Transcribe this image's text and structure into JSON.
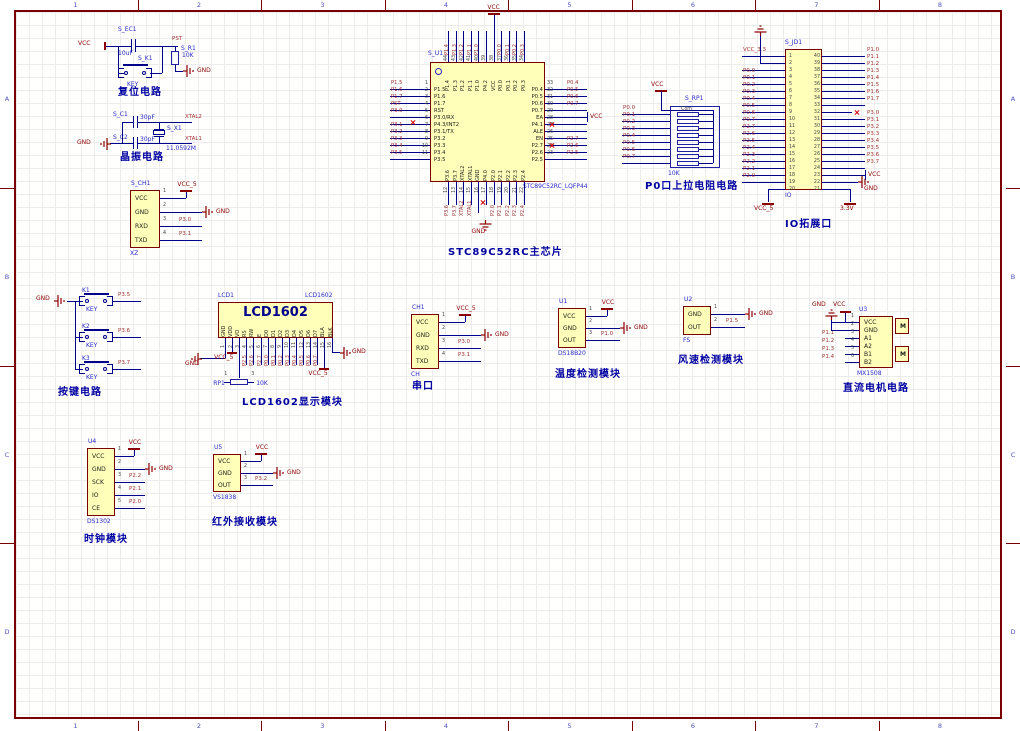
{
  "sheet": {
    "zone_cols": [
      "1",
      "2",
      "3",
      "4",
      "5",
      "6",
      "7",
      "8"
    ],
    "zone_rows": [
      "A",
      "B",
      "C",
      "D"
    ]
  },
  "captions": {
    "reset": "复位电路",
    "crystal": "晶振电路",
    "mcu": "STC89C52RC主芯片",
    "pullup": "P0口上拉电阻电路",
    "io": "IO拓展口",
    "keys": "按键电路",
    "lcd": "LCD1602显示模块",
    "serial": "串口",
    "temp": "温度检测模块",
    "wind": "风速检测模块",
    "motor": "直流电机电路",
    "clock": "时钟模块",
    "ir": "红外接收模块"
  },
  "reset": {
    "vcc": "VCC",
    "cap_ref": "S_EC1",
    "cap_val": "10uF",
    "key_ref": "S_K1",
    "key_label": "KEY",
    "pst": "PST",
    "res_ref": "S_R1",
    "res_val": "10K",
    "gnd": "GND"
  },
  "crystal": {
    "c1_ref": "S_C1",
    "c1_val": "30pF",
    "net_top": "XTAL2",
    "c2_ref": "S_C2",
    "c2_val": "30pF",
    "net_bottom": "XTAL1",
    "x_ref": "S_X1",
    "x_val": "11.0592M",
    "gnd": "GND"
  },
  "xz": {
    "ref": "S_CH1",
    "part": "XZ",
    "pins": [
      {
        "num": "1",
        "name": "VCC",
        "net": "VCC_5",
        "sym": "vcc"
      },
      {
        "num": "2",
        "name": "GND",
        "net": "GND",
        "sym": "gnd"
      },
      {
        "num": "3",
        "name": "RXD",
        "net": "P3.0",
        "sym": "label"
      },
      {
        "num": "4",
        "name": "TXD",
        "net": "P3.1",
        "sym": "label"
      }
    ]
  },
  "serial": {
    "ref": "CH1",
    "part": "CH",
    "pins": [
      {
        "num": "1",
        "name": "VCC",
        "net": "VCC_5",
        "sym": "vcc"
      },
      {
        "num": "2",
        "name": "GND",
        "net": "GND",
        "sym": "gnd"
      },
      {
        "num": "3",
        "name": "RXD",
        "net": "P3.0",
        "sym": "label"
      },
      {
        "num": "4",
        "name": "TXD",
        "net": "P3.1",
        "sym": "label"
      }
    ]
  },
  "temp": {
    "ref": "U1",
    "part": "DS18B20",
    "pins": [
      {
        "num": "1",
        "name": "VCC",
        "net": "VCC",
        "sym": "vcc"
      },
      {
        "num": "2",
        "name": "GND",
        "net": "GND",
        "sym": "gnd"
      },
      {
        "num": "3",
        "name": "OUT",
        "net": "P1.0",
        "sym": "label"
      }
    ]
  },
  "wind": {
    "ref": "U2",
    "part": "FS",
    "pins": [
      {
        "num": "1",
        "name": "GND",
        "net": "GND",
        "sym": "gnd"
      },
      {
        "num": "2",
        "name": "OUT",
        "net": "P1.5",
        "sym": "label"
      }
    ]
  },
  "clock": {
    "ref": "U4",
    "part": "DS1302",
    "pins": [
      {
        "num": "1",
        "name": "VCC",
        "net": "VCC",
        "sym": "vcc"
      },
      {
        "num": "2",
        "name": "GND",
        "net": "GND",
        "sym": "gnd"
      },
      {
        "num": "3",
        "name": "SCK",
        "net": "P2.2",
        "sym": "label"
      },
      {
        "num": "4",
        "name": "IO",
        "net": "P2.1",
        "sym": "label"
      },
      {
        "num": "5",
        "name": "CE",
        "net": "P2.0",
        "sym": "label"
      }
    ]
  },
  "ir": {
    "ref": "U5",
    "part": "VS1838",
    "pins": [
      {
        "num": "1",
        "name": "VCC",
        "net": "VCC",
        "sym": "vcc"
      },
      {
        "num": "2",
        "name": "GND",
        "net": "GND",
        "sym": "gnd"
      },
      {
        "num": "3",
        "name": "OUT",
        "net": "P3.2",
        "sym": "label"
      }
    ]
  },
  "motor": {
    "ref": "U3",
    "part": "MX1508",
    "gnd": "GND",
    "vcc": "VCC",
    "m_label": "M",
    "pins": [
      {
        "num": "1",
        "name": "VCC"
      },
      {
        "num": "2",
        "name": "GND"
      },
      {
        "num": "3",
        "name": "A1",
        "net": "P1.1"
      },
      {
        "num": "4",
        "name": "A2",
        "net": "P1.2"
      },
      {
        "num": "5",
        "name": "B1",
        "net": "P1.3"
      },
      {
        "num": "6",
        "name": "B2",
        "net": "P1.4"
      }
    ]
  },
  "keys": {
    "gnd": "GND",
    "items": [
      {
        "ref": "K1",
        "label": "KEY",
        "net": "P3.5"
      },
      {
        "ref": "K2",
        "label": "KEY",
        "net": "P3.6"
      },
      {
        "ref": "K3",
        "label": "KEY",
        "net": "P3.7"
      }
    ]
  },
  "pullup": {
    "ref": "S_RP1",
    "com": "Com",
    "value": "10K",
    "vcc": "VCC",
    "nets": [
      "P0.0",
      "P0.1",
      "P0.2",
      "P0.3",
      "P0.4",
      "P0.5",
      "P0.6",
      "P0.7"
    ]
  },
  "lcd": {
    "ref": "LCD1",
    "part": "LCD1602",
    "title": "LCD1602",
    "pot_ref": "RP1",
    "pot_val": "10K",
    "pot_p1": "1",
    "pot_p3": "3",
    "vcc_left": "VCC_5",
    "vcc_right": "VCC_5",
    "gnd_left": "GND",
    "gnd_right": "GND",
    "pins": [
      {
        "num": "1",
        "name": "GND",
        "sym": "gnd-left"
      },
      {
        "num": "2",
        "name": "VDD",
        "sym": "vccl"
      },
      {
        "num": "3",
        "name": "VO",
        "sym": "pot"
      },
      {
        "num": "4",
        "name": "RS",
        "net": "P2.5"
      },
      {
        "num": "5",
        "name": "RW",
        "net": "P2.6"
      },
      {
        "num": "6",
        "name": "E",
        "net": "P2.7"
      },
      {
        "num": "7",
        "name": "D0",
        "net": "P0.0"
      },
      {
        "num": "8",
        "name": "D1",
        "net": "P0.1"
      },
      {
        "num": "9",
        "name": "D2",
        "net": "P0.2"
      },
      {
        "num": "10",
        "name": "D3",
        "net": "P0.3"
      },
      {
        "num": "11",
        "name": "D4",
        "net": "P0.4"
      },
      {
        "num": "12",
        "name": "D5",
        "net": "P0.5"
      },
      {
        "num": "13",
        "name": "D6",
        "net": "P0.6"
      },
      {
        "num": "14",
        "name": "D7",
        "net": "P0.7"
      },
      {
        "num": "15",
        "name": "BLA",
        "sym": "vccr"
      },
      {
        "num": "16",
        "name": "BLK",
        "sym": "gnd-right"
      }
    ]
  },
  "mcu": {
    "ref": "S_U1",
    "part": "STC89C52RC_LQFP44",
    "vcc": "VCC",
    "gnd": "GND",
    "left": [
      {
        "num": "1",
        "name": "P1.5",
        "net": "P1.5"
      },
      {
        "num": "2",
        "name": "P1.6",
        "net": "P1.6"
      },
      {
        "num": "3",
        "name": "P1.7",
        "net": "P1.7"
      },
      {
        "num": "4",
        "name": "RST",
        "net": "PST"
      },
      {
        "num": "5",
        "name": "P3.0/RX",
        "net": "P3.0"
      },
      {
        "num": "6",
        "name": "P4.3/INT2",
        "net": ""
      },
      {
        "num": "7",
        "name": "P3.1/TX",
        "net": "P3.1"
      },
      {
        "num": "8",
        "name": "P3.2",
        "net": "P3.2"
      },
      {
        "num": "9",
        "name": "P3.3",
        "net": "P3.3"
      },
      {
        "num": "10",
        "name": "P3.4",
        "net": "P3.4"
      },
      {
        "num": "11",
        "name": "P3.5",
        "net": "P3.5"
      }
    ],
    "right": [
      {
        "num": "33",
        "name": "P0.4",
        "net": "P0.4"
      },
      {
        "num": "32",
        "name": "P0.5",
        "net": "P0.5"
      },
      {
        "num": "31",
        "name": "P0.6",
        "net": "P0.6"
      },
      {
        "num": "30",
        "name": "P0.7",
        "net": "P0.7"
      },
      {
        "num": "29",
        "name": "EA",
        "net": "VCC",
        "sym": "vcc"
      },
      {
        "num": "28",
        "name": "P4.1",
        "net": ""
      },
      {
        "num": "27",
        "name": "ALE",
        "net": ""
      },
      {
        "num": "26",
        "name": "EN",
        "net": ""
      },
      {
        "num": "25",
        "name": "P2.7",
        "net": "P2.7"
      },
      {
        "num": "24",
        "name": "P2.6",
        "net": "P2.6"
      },
      {
        "num": "23",
        "name": "P2.5",
        "net": "P2.5"
      }
    ],
    "top": [
      {
        "num": "44",
        "name": "P1.4",
        "net": "P1.4"
      },
      {
        "num": "43",
        "name": "P1.3",
        "net": "P1.3"
      },
      {
        "num": "42",
        "name": "P1.2",
        "net": "P1.2"
      },
      {
        "num": "41",
        "name": "P1.1",
        "net": "P1.1"
      },
      {
        "num": "40",
        "name": "P1.0",
        "net": "P1.0"
      },
      {
        "num": "39",
        "name": "P4.2",
        "net": ""
      },
      {
        "num": "38",
        "name": "VCC",
        "net": "VCC",
        "sym": "vcc"
      },
      {
        "num": "37",
        "name": "P0.0",
        "net": "P0.0"
      },
      {
        "num": "36",
        "name": "P0.1",
        "net": "P0.1"
      },
      {
        "num": "35",
        "name": "P0.2",
        "net": "P0.2"
      },
      {
        "num": "34",
        "name": "P0.3",
        "net": "P0.3"
      }
    ],
    "bottom": [
      {
        "num": "12",
        "name": "P3.6",
        "net": "P3.6"
      },
      {
        "num": "13",
        "name": "P3.7",
        "net": "P3.7"
      },
      {
        "num": "14",
        "name": "XTAL2",
        "net": "XTAL2"
      },
      {
        "num": "15",
        "name": "XTAL1",
        "net": "XTAL1"
      },
      {
        "num": "16",
        "name": "GND",
        "net": "GND",
        "sym": "gnd"
      },
      {
        "num": "17",
        "name": "P4.0",
        "net": ""
      },
      {
        "num": "18",
        "name": "P2.0",
        "net": "P2.0"
      },
      {
        "num": "19",
        "name": "P2.1",
        "net": "P2.1"
      },
      {
        "num": "20",
        "name": "P2.2",
        "net": "P2.2"
      },
      {
        "num": "21",
        "name": "P2.3",
        "net": "P2.3"
      },
      {
        "num": "22",
        "name": "P2.4",
        "net": "P2.4"
      }
    ]
  },
  "io": {
    "ref": "S_JD1",
    "part": "IO",
    "vcc5": "VCC_5",
    "v33": "3.3V",
    "vcc": "VCC",
    "gnd": "GND",
    "left": [
      {
        "num": "1",
        "net": "VCC_3.3",
        "sym": "label"
      },
      {
        "num": "2",
        "sym": "gnd-up"
      },
      {
        "num": "3"
      },
      {
        "num": "4",
        "net": "P0.0",
        "sym": "label"
      },
      {
        "num": "5",
        "net": "P0.1",
        "sym": "label"
      },
      {
        "num": "6",
        "net": "P0.2",
        "sym": "label"
      },
      {
        "num": "7",
        "net": "P0.3",
        "sym": "label"
      },
      {
        "num": "8",
        "net": "P0.4",
        "sym": "label"
      },
      {
        "num": "9",
        "net": "P0.5",
        "sym": "label"
      },
      {
        "num": "10",
        "net": "P0.6",
        "sym": "label"
      },
      {
        "num": "11",
        "net": "P0.7",
        "sym": "label"
      },
      {
        "num": "12",
        "net": "P2.7",
        "sym": "label"
      },
      {
        "num": "13",
        "net": "P2.6",
        "sym": "label"
      },
      {
        "num": "14",
        "net": "P2.5",
        "sym": "label"
      },
      {
        "num": "15",
        "net": "P2.4",
        "sym": "label"
      },
      {
        "num": "16",
        "net": "P2.3",
        "sym": "label"
      },
      {
        "num": "17",
        "net": "P2.2",
        "sym": "label"
      },
      {
        "num": "18",
        "net": "P2.1",
        "sym": "label"
      },
      {
        "num": "19",
        "net": "P2.0",
        "sym": "label"
      },
      {
        "num": "20",
        "net": "VCC_5",
        "sym": "down"
      }
    ],
    "right": [
      {
        "num": "40",
        "net": "P1.0",
        "sym": "label"
      },
      {
        "num": "39",
        "net": "P1.1",
        "sym": "label"
      },
      {
        "num": "38",
        "net": "P1.2",
        "sym": "label"
      },
      {
        "num": "37",
        "net": "P1.3",
        "sym": "label"
      },
      {
        "num": "36",
        "net": "P1.4",
        "sym": "label"
      },
      {
        "num": "35",
        "net": "P1.5",
        "sym": "label"
      },
      {
        "num": "34",
        "net": "P1.6",
        "sym": "label"
      },
      {
        "num": "33",
        "net": "P1.7",
        "sym": "label"
      },
      {
        "num": "32",
        "sym": "xmark"
      },
      {
        "num": "31",
        "net": "P3.0",
        "sym": "label"
      },
      {
        "num": "30",
        "net": "P3.1",
        "sym": "label"
      },
      {
        "num": "29",
        "net": "P3.2",
        "sym": "label"
      },
      {
        "num": "28",
        "net": "P3.3",
        "sym": "label"
      },
      {
        "num": "27",
        "net": "P3.4",
        "sym": "label"
      },
      {
        "num": "26",
        "net": "P3.5",
        "sym": "label"
      },
      {
        "num": "25",
        "net": "P3.6",
        "sym": "label"
      },
      {
        "num": "24",
        "net": "P3.7",
        "sym": "label"
      },
      {
        "num": "23",
        "net": "VCC",
        "sym": "vcc"
      },
      {
        "num": "22",
        "net": "GND",
        "sym": "gnd"
      },
      {
        "num": "21",
        "net": "3.3V",
        "sym": "down"
      }
    ]
  }
}
